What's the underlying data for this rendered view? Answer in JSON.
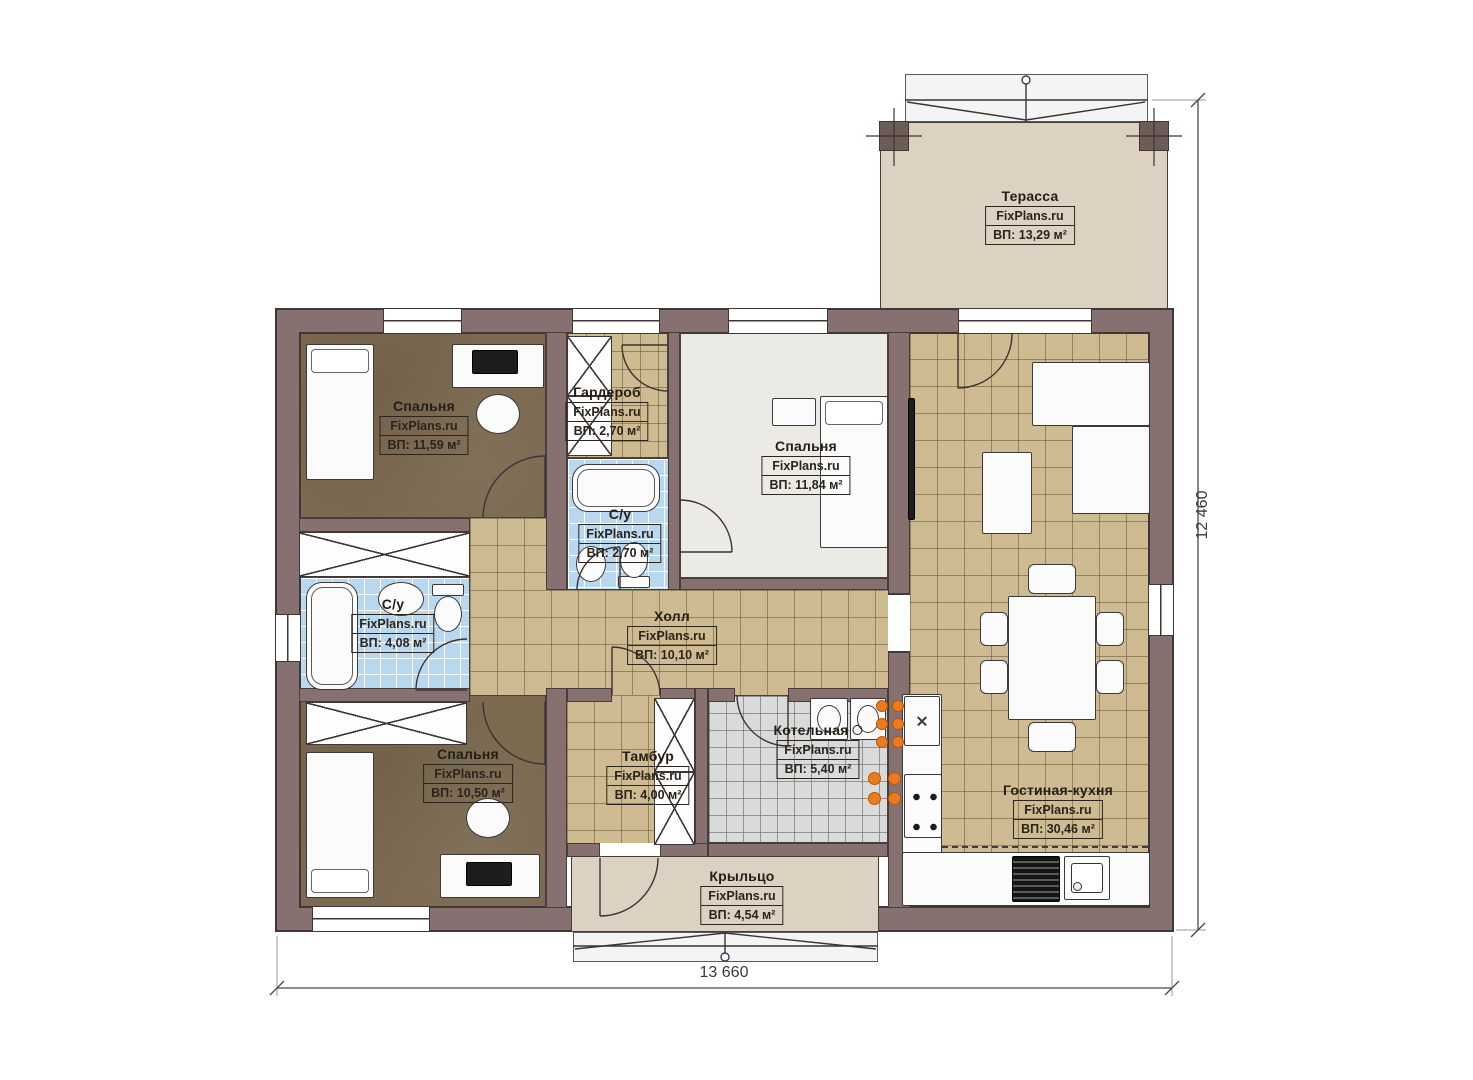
{
  "watermark": "FixPlans.ru",
  "dimensions": {
    "width": "13 660",
    "height": "12 460"
  },
  "rooms": {
    "terrace": {
      "name": "Терасса",
      "area": "ВП: 13,29 м²"
    },
    "bedroom1": {
      "name": "Спальня",
      "area": "ВП: 11,59 м²"
    },
    "wardrobe": {
      "name": "Гардероб",
      "area": "ВП: 2,70 м²"
    },
    "bedroom2": {
      "name": "Спальня",
      "area": "ВП: 11,84 м²"
    },
    "wc_small": {
      "name": "С/у",
      "area": "ВП: 2,70 м²"
    },
    "wc_big": {
      "name": "С/у",
      "area": "ВП: 4,08 м²"
    },
    "hall": {
      "name": "Холл",
      "area": "ВП: 10,10 м²"
    },
    "bedroom3": {
      "name": "Спальня",
      "area": "ВП: 10,50 м²"
    },
    "tambur": {
      "name": "Тамбур",
      "area": "ВП: 4,00 м²"
    },
    "boiler": {
      "name": "Котельная",
      "area": "ВП: 5,40 м²"
    },
    "living": {
      "name": "Гостиная-кухня",
      "area": "ВП: 30,46 м²"
    },
    "porch": {
      "name": "Крыльцо",
      "area": "ВП: 4,54 м²"
    }
  },
  "colors": {
    "wall": "#867170",
    "wall_outline": "#403737",
    "floor_wood": "#7b6950",
    "floor_tile_tan": "#cebb92",
    "floor_tile_blue": "#b9d7ee",
    "floor_tile_gray": "#dadada",
    "floor_beige": "#ddd2c1",
    "radiator_orange": "#ed7b1c"
  }
}
